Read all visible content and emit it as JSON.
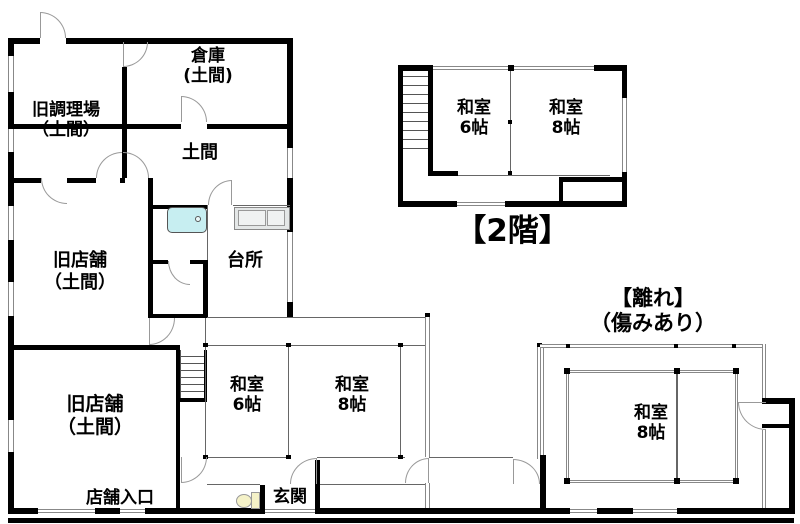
{
  "floorplan": {
    "main_building_1f": {
      "rooms": {
        "storage": "倉庫\n(土間)",
        "old_cooking_area": "旧調理場\n（土間）",
        "doma": "土間",
        "old_shop_upper": "旧店舗\n（土間）",
        "kitchen": "台所",
        "old_shop_lower": "旧店舗\n（土間）",
        "washitsu_6": "和室\n6帖",
        "washitsu_8": "和室\n8帖",
        "shop_entrance": "店舗入口",
        "entrance": "玄関"
      }
    },
    "second_floor": {
      "caption": "【2階】",
      "rooms": {
        "washitsu_6": "和室\n6帖",
        "washitsu_8": "和室\n8帖"
      }
    },
    "annex": {
      "caption": "【離れ】\n（傷みあり）",
      "rooms": {
        "washitsu_8": "和室\n8帖"
      }
    },
    "fixtures": {
      "bathtub": "bathtub-icon",
      "kitchen_counter": "kitchen-counter-icon",
      "toilet": "toilet-icon",
      "stairs_main": "staircase",
      "stairs_2f": "staircase"
    },
    "colors": {
      "wall": "#000000",
      "window_line": "#888888",
      "door_arc": "#999999",
      "bathtub_fill": "#c7eef1",
      "counter_fill": "#e4e7e7",
      "toilet_fill": "#f5f2c8",
      "background": "#ffffff"
    }
  }
}
